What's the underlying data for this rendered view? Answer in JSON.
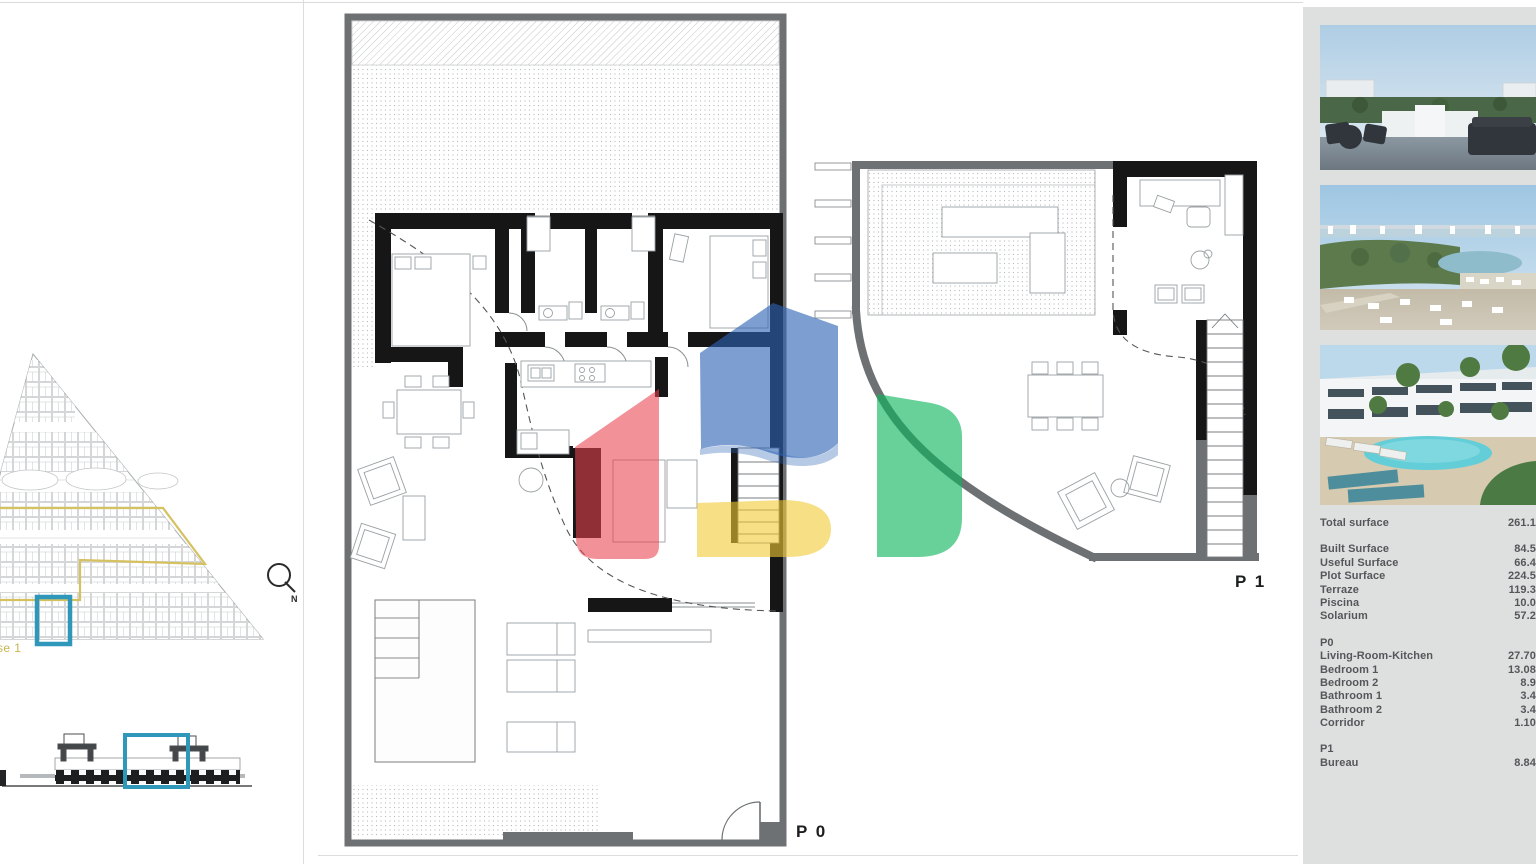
{
  "document": {
    "floor_labels": {
      "p0": "P 0",
      "p1": "P 1"
    },
    "site_plan": {
      "phase_label": "se 1",
      "north_label": "N"
    },
    "photos": [
      {
        "id": "roof-terrace-photo"
      },
      {
        "id": "aerial-landscape-photo"
      },
      {
        "id": "pool-residences-photo"
      }
    ],
    "surfaces": {
      "total": {
        "label": "Total surface",
        "value": "261.1"
      },
      "general": [
        {
          "label": "Built Surface",
          "value": "84.5"
        },
        {
          "label": "Useful Surface",
          "value": "66.4"
        },
        {
          "label": "Plot Surface",
          "value": "224.5"
        },
        {
          "label": "Terraze",
          "value": "119.3"
        },
        {
          "label": "Piscina",
          "value": "10.0"
        },
        {
          "label": "Solarium",
          "value": "57.2"
        }
      ],
      "p0": {
        "heading": "P0",
        "rows": [
          {
            "label": "Living-Room-Kitchen",
            "value": "27.70"
          },
          {
            "label": "Bedroom 1",
            "value": "13.08"
          },
          {
            "label": "Bedroom 2",
            "value": "8.9"
          },
          {
            "label": "Bathroom 1",
            "value": "3.4"
          },
          {
            "label": "Bathroom 2",
            "value": "3.4"
          },
          {
            "label": "Corridor",
            "value": "1.10"
          }
        ]
      },
      "p1": {
        "heading": "P1",
        "rows": [
          {
            "label": "Bureau",
            "value": "8.84"
          }
        ]
      }
    },
    "colors": {
      "panel_bg": "#dee0e0",
      "text": "#54575a",
      "plot_wall_gray": "#6e7173",
      "house_wall_black": "#161616",
      "site_highlight_yellow": "#d6c160",
      "unit_highlight_blue": "#2f97ba",
      "watermark_red": "#e8414e",
      "watermark_blue": "#2d63b5",
      "watermark_yellow": "#f2ca35",
      "watermark_green": "#0cb55c"
    }
  }
}
